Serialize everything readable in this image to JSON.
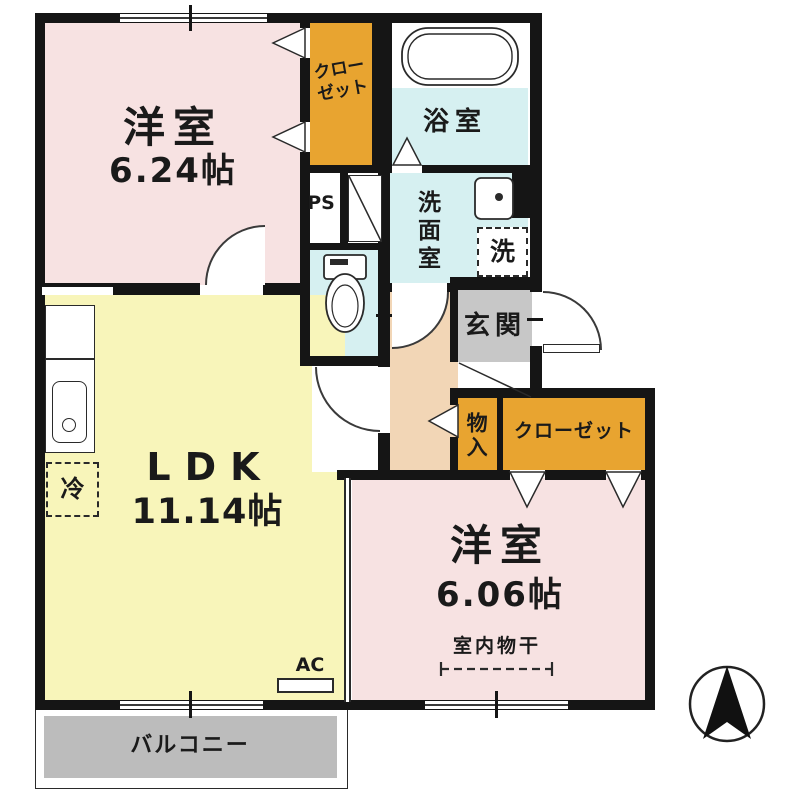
{
  "title": "1LDK floor plan",
  "rooms": {
    "bedroom1": {
      "label": "洋室",
      "size": "6.24帖"
    },
    "closet1": {
      "line1": "クロー",
      "line2": "ゼット"
    },
    "bath": {
      "label": "浴室"
    },
    "ps": {
      "label": "PS"
    },
    "washroom": {
      "label": "洗面室"
    },
    "laundry": {
      "label": "洗"
    },
    "entrance": {
      "label": "玄関"
    },
    "storage": {
      "label": "物入"
    },
    "closet2": {
      "label": "クローゼット"
    },
    "ldk": {
      "label": "LDK",
      "size": "11.14帖"
    },
    "fridge": {
      "label": "冷"
    },
    "bedroom2": {
      "label": "洋室",
      "size": "6.06帖",
      "drying_note": "室内物干"
    },
    "ac": {
      "label": "AC"
    },
    "balcony": {
      "label": "バルコニー"
    }
  },
  "colors": {
    "room_pink": "#f7e2e2",
    "ldk_yellow": "#f8f5ba",
    "closet_orange": "#e8a430",
    "wet_blue": "#d6f0f1",
    "hall_peach": "#f2d6b6",
    "entrance_gray": "#c7c7c7",
    "balcony_gray": "#bcbcbc",
    "wall_black": "#151515"
  },
  "icons": {
    "compass": "north-arrow"
  }
}
